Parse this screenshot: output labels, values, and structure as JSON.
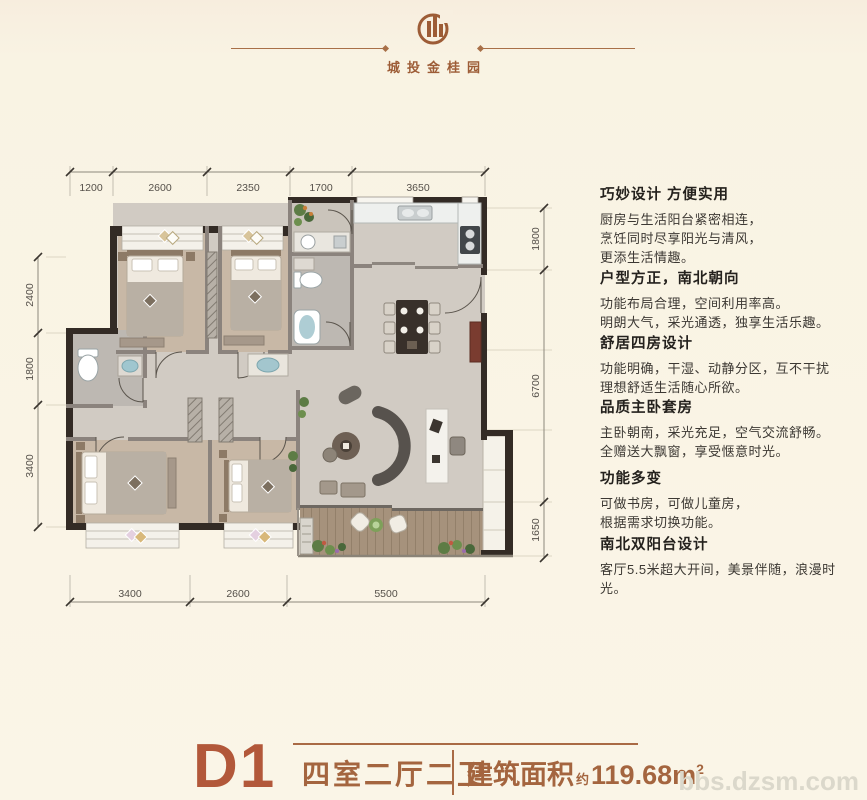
{
  "brand": {
    "name": "城投金桂园"
  },
  "panel": {
    "blocks": [
      {
        "title": "巧妙设计 方便实用",
        "lines": [
          "厨房与生活阳台紧密相连，",
          "烹饪同时尽享阳光与清风，",
          "更添生活情趣。"
        ]
      },
      {
        "title": "户型方正，南北朝向",
        "lines": [
          "功能布局合理，空间利用率高。",
          "明朗大气，采光通透，独享生活乐趣。"
        ]
      },
      {
        "title": "舒居四房设计",
        "lines": [
          "功能明确，干湿、动静分区，互不干扰",
          "理想舒适生活随心所欲。"
        ]
      },
      {
        "title": "品质主卧套房",
        "lines": [
          "主卧朝南，采光充足，空气交流舒畅。",
          "全赠送大飘窗，享受惬意时光。"
        ]
      },
      {
        "title": "功能多变",
        "lines": [
          "可做书房，可做儿童房，",
          "根据需求切换功能。"
        ]
      },
      {
        "title": "南北双阳台设计",
        "lines": [
          "客厅5.5米超大开间，美景伴随，浪漫时光。"
        ]
      }
    ]
  },
  "dims": {
    "top": [
      "1200",
      "2600",
      "2350",
      "1700",
      "3650"
    ],
    "left": [
      "2400",
      "1800",
      "3400"
    ],
    "right": [
      "1800",
      "6700",
      "1650"
    ],
    "bottom": [
      "3400",
      "2600",
      "5500"
    ]
  },
  "footer": {
    "unit": "D1",
    "layout": "四室二厅二卫",
    "area_label": "建筑面积",
    "area_approx": "约",
    "area_value": "119.68m",
    "area_sup": "2"
  },
  "watermark": "bbs.dzsm.com",
  "colors": {
    "accent": "#9d5c36",
    "unit_red": "#b2583a",
    "cream": "#f9f3e3",
    "wall_dark": "#332b25",
    "wall_gray": "#8b837d"
  }
}
